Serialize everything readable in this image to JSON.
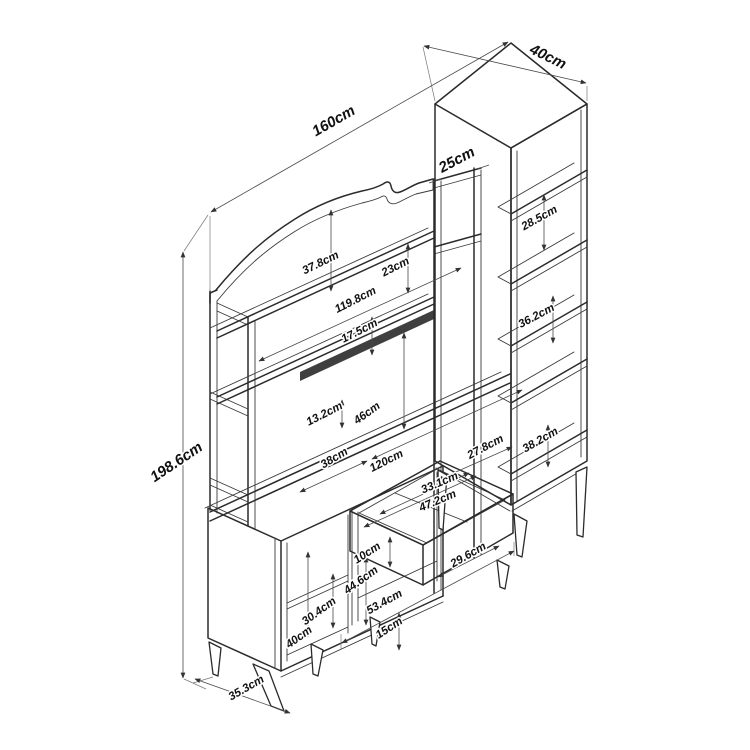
{
  "canvas": {
    "width": 750,
    "height": 750,
    "background": "#ffffff",
    "line_color": "#2b2b2b",
    "dimension_line_color": "#4a4a4a",
    "text_color": "#111111"
  },
  "diagram": {
    "type": "furniture-dimension-drawing",
    "subject": "isometric line drawing of a wall unit: hutch with curved pediment, open shelves, base cabinets with open drawer, and tall side bookcase",
    "unit": "cm",
    "dimensions": [
      {
        "id": "overall-width",
        "label": "160cm",
        "x": 336,
        "y": 125,
        "rot": -30,
        "size": 15,
        "bold": true
      },
      {
        "id": "column-depth",
        "label": "40cm",
        "x": 546,
        "y": 61,
        "rot": 26,
        "size": 15,
        "bold": true
      },
      {
        "id": "top-frame-width",
        "label": "25cm",
        "x": 459,
        "y": 164,
        "rot": -28,
        "size": 15,
        "bold": true
      },
      {
        "id": "overall-height",
        "label": "198.6cm",
        "x": 179,
        "y": 466,
        "rot": -34,
        "size": 15,
        "bold": true
      },
      {
        "id": "pediment-height",
        "label": "37.8cm",
        "x": 322,
        "y": 266,
        "rot": -26,
        "size": 11.5,
        "bold": true
      },
      {
        "id": "shelf-gap-top",
        "label": "23cm",
        "x": 397,
        "y": 270,
        "rot": -27,
        "size": 11.5,
        "bold": true
      },
      {
        "id": "hutch-inner-width",
        "label": "119.8cm",
        "x": 357,
        "y": 303,
        "rot": -27,
        "size": 11.5,
        "bold": true
      },
      {
        "id": "shelf-gap-mid",
        "label": "17.5cm",
        "x": 361,
        "y": 334,
        "rot": -27,
        "size": 11.5,
        "bold": true
      },
      {
        "id": "rail-height",
        "label": "13.2cm",
        "x": 326,
        "y": 417,
        "rot": -27,
        "size": 11.5,
        "bold": true
      },
      {
        "id": "niche-height",
        "label": "46cm",
        "x": 369,
        "y": 416,
        "rot": -36,
        "size": 11.5,
        "bold": true
      },
      {
        "id": "counter-left-width",
        "label": "38cm",
        "x": 336,
        "y": 461,
        "rot": -31,
        "size": 11.5,
        "bold": true
      },
      {
        "id": "counter-width",
        "label": "120cm",
        "x": 388,
        "y": 464,
        "rot": -27,
        "size": 11.5,
        "bold": true
      },
      {
        "id": "counter-right-width",
        "label": "27.8cm",
        "x": 487,
        "y": 450,
        "rot": -28,
        "size": 11.5,
        "bold": true
      },
      {
        "id": "drawer-inner-depth",
        "label": "33.1cm",
        "x": 441,
        "y": 486,
        "rot": -23,
        "size": 11.5,
        "bold": true
      },
      {
        "id": "drawer-width",
        "label": "47.2cm",
        "x": 439,
        "y": 504,
        "rot": -23,
        "size": 11.5,
        "bold": true
      },
      {
        "id": "drawer-height",
        "label": "10cm",
        "x": 369,
        "y": 556,
        "rot": -33,
        "size": 11.5,
        "bold": true
      },
      {
        "id": "base-inner-height",
        "label": "44.6cm",
        "x": 363,
        "y": 583,
        "rot": -36,
        "size": 11.5,
        "bold": true
      },
      {
        "id": "base-opening-width",
        "label": "29.6cm",
        "x": 470,
        "y": 558,
        "rot": -30,
        "size": 11.5,
        "bold": true
      },
      {
        "id": "base-width",
        "label": "53.4cm",
        "x": 386,
        "y": 605,
        "rot": -29,
        "size": 11.5,
        "bold": true
      },
      {
        "id": "leg-height",
        "label": "15cm",
        "x": 391,
        "y": 631,
        "rot": -33,
        "size": 11.5,
        "bold": true
      },
      {
        "id": "cabinet-shelf-gap",
        "label": "30.4cm",
        "x": 321,
        "y": 614,
        "rot": -36,
        "size": 11.5,
        "bold": true
      },
      {
        "id": "cabinet-height",
        "label": "40cm",
        "x": 301,
        "y": 640,
        "rot": -36,
        "size": 11.5,
        "bold": true
      },
      {
        "id": "cabinet-depth",
        "label": "35.3cm",
        "x": 248,
        "y": 691,
        "rot": -30,
        "size": 11.5,
        "bold": true
      },
      {
        "id": "column-gap-1",
        "label": "28.5cm",
        "x": 541,
        "y": 221,
        "rot": -29,
        "size": 11.5,
        "bold": true
      },
      {
        "id": "column-gap-2",
        "label": "36.2cm",
        "x": 538,
        "y": 319,
        "rot": -28,
        "size": 11.5,
        "bold": true
      },
      {
        "id": "column-gap-3",
        "label": "38.2cm",
        "x": 542,
        "y": 443,
        "rot": -30,
        "size": 11.5,
        "bold": true
      }
    ]
  }
}
